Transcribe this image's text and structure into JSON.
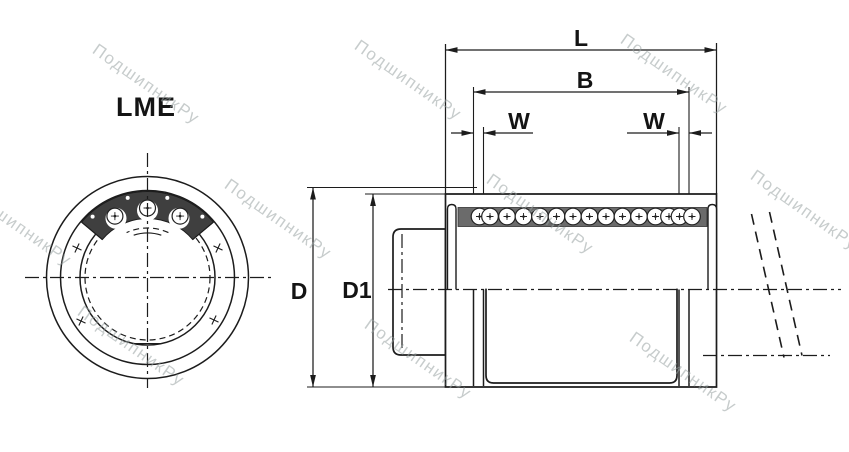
{
  "drawing_title": "LME",
  "dimension_labels": {
    "overall_length": "L",
    "between_grooves": "B",
    "groove_width": "W",
    "outer_diameter": "D",
    "inner_diameter_2": "D1"
  },
  "watermark": {
    "text": "ПодшипникРу"
  },
  "colors": {
    "line": "#1c1c1c",
    "retainer_fill": "#3f3f3f",
    "ball_track_fill": "#6b6b6b",
    "watermark_text": "#9aa4a4",
    "background": "#ffffff"
  }
}
